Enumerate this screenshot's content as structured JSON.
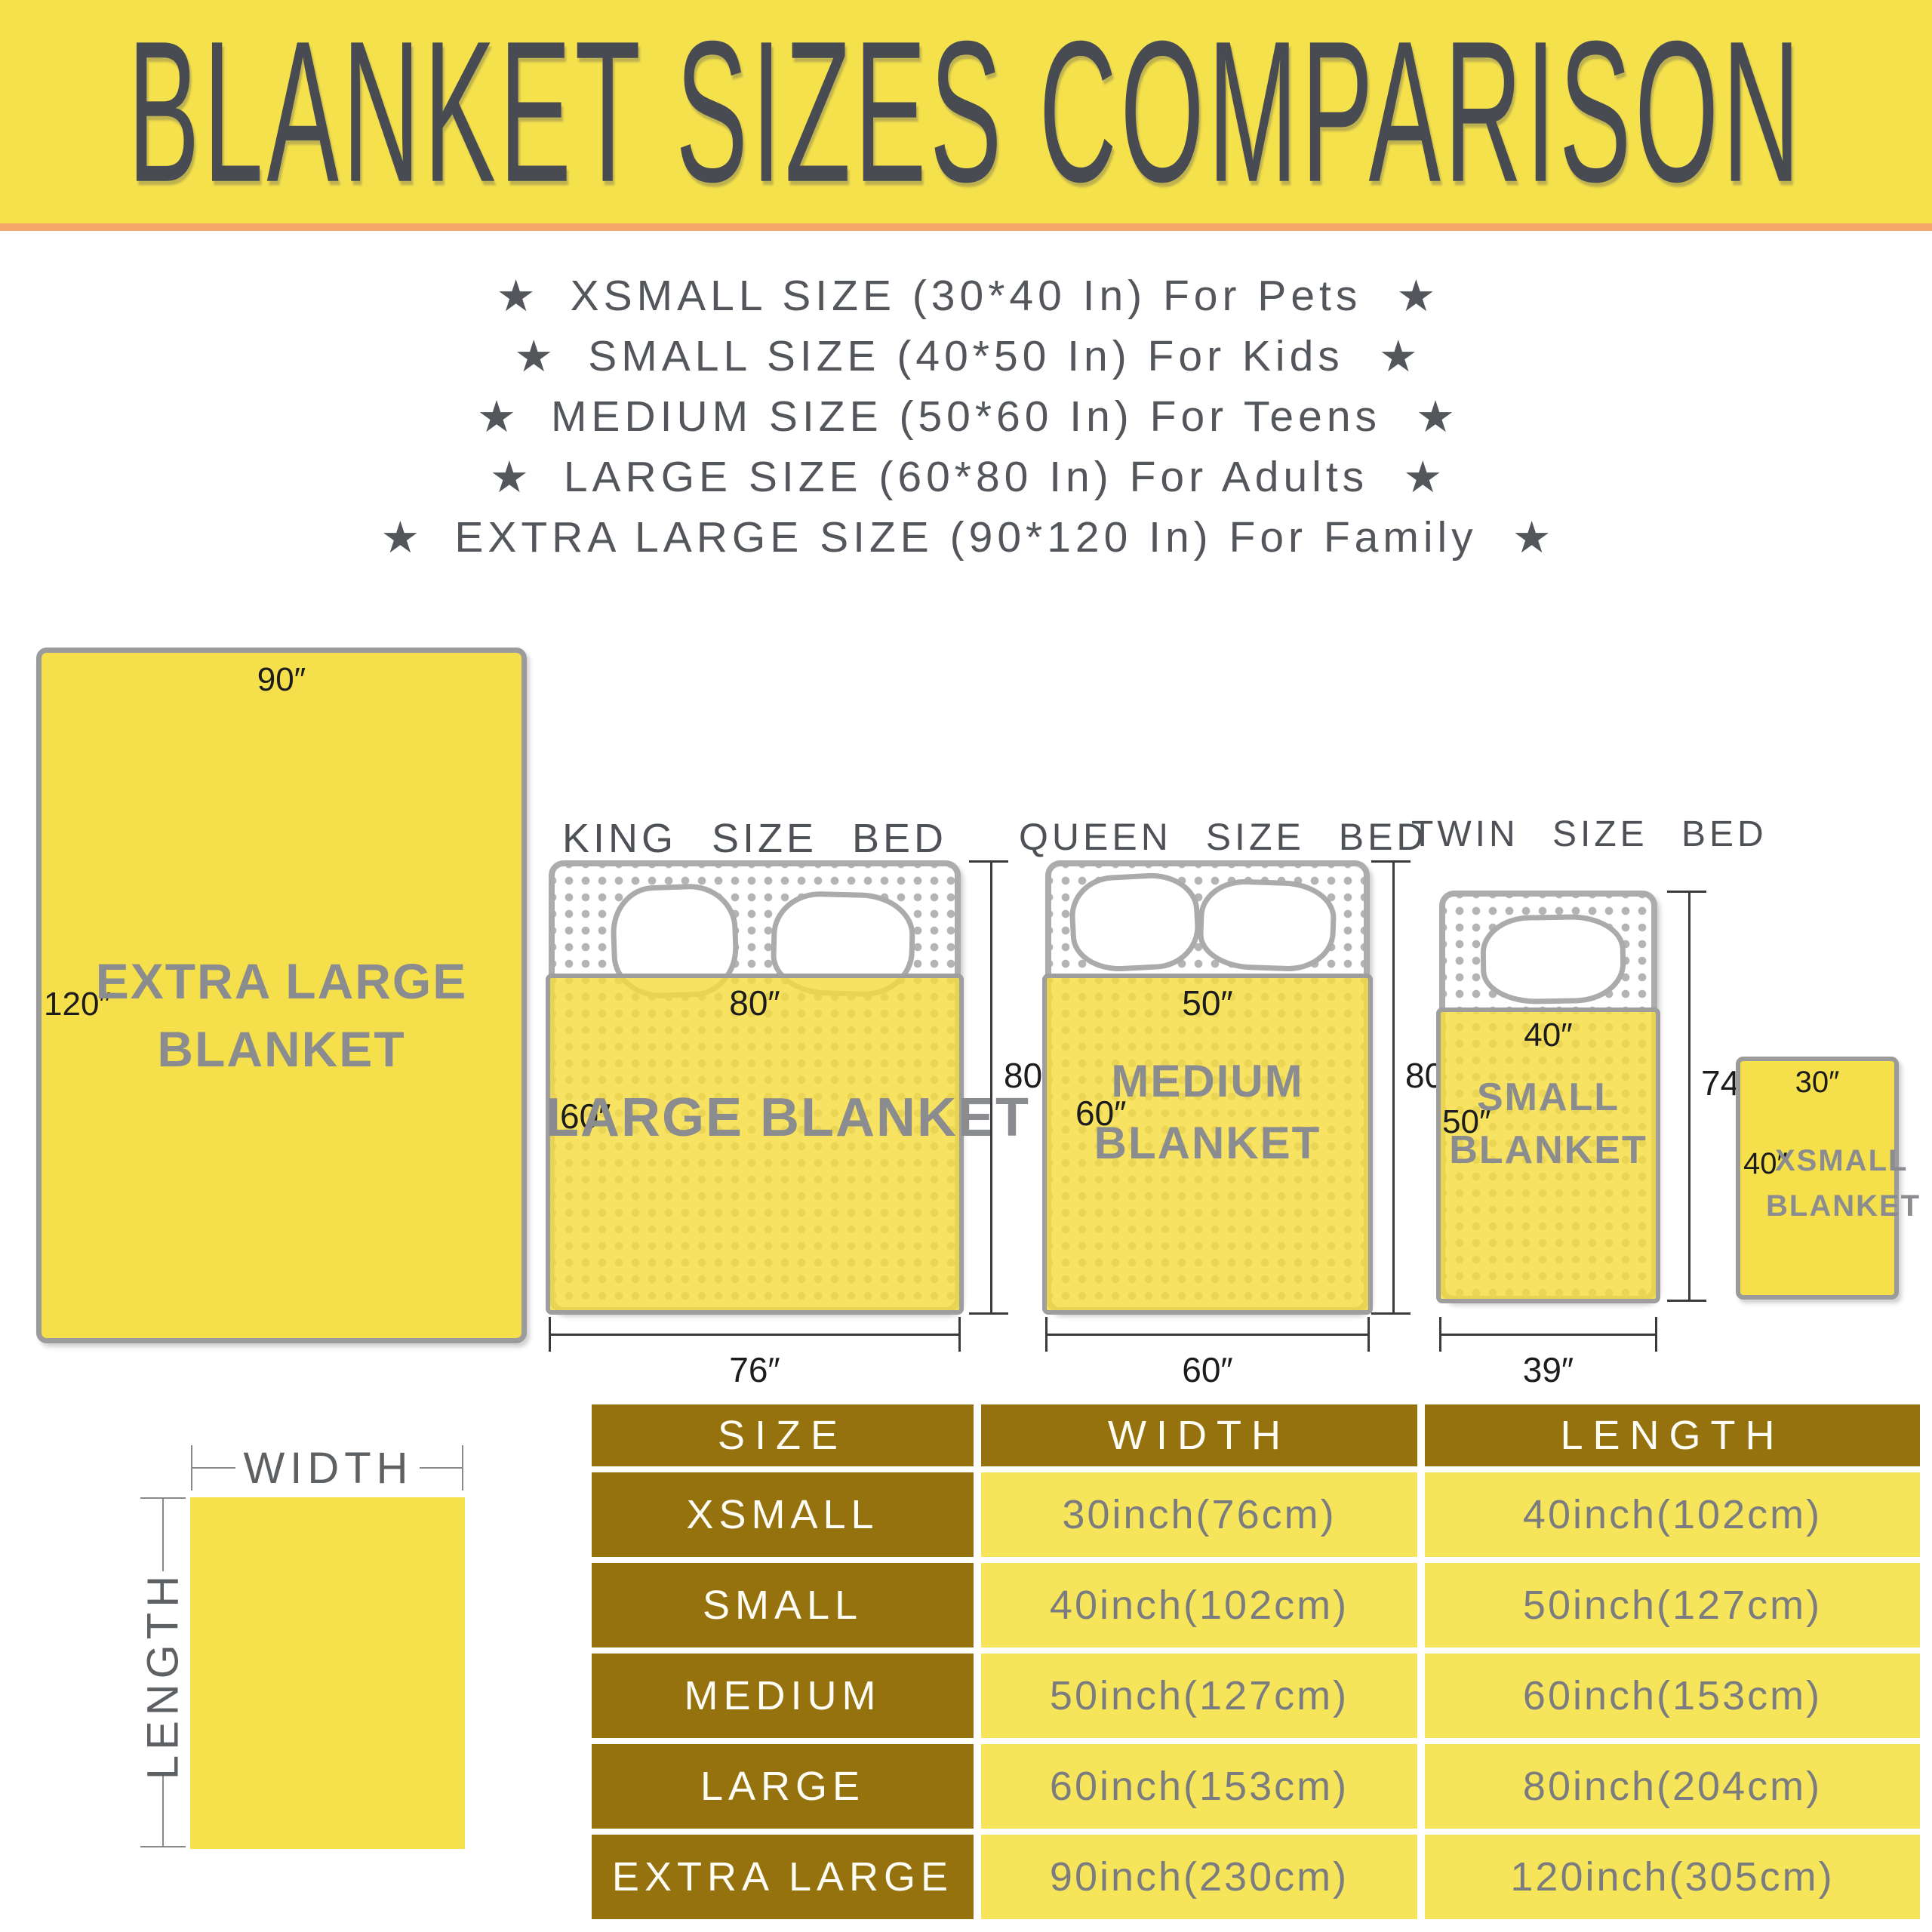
{
  "banner": {
    "title": "BLANKET SIZES COMPARISON",
    "bg": "#F5E14C",
    "accent_line_color": "#F3A76A"
  },
  "icons": {
    "star": "★"
  },
  "size_list": [
    {
      "text": "XSMALL SIZE (30*40 In) For Pets"
    },
    {
      "text": "SMALL SIZE (40*50 In) For Kids"
    },
    {
      "text": "MEDIUM SIZE (50*60 In) For Teens"
    },
    {
      "text": "LARGE SIZE (60*80 In) For Adults"
    },
    {
      "text": "EXTRA LARGE SIZE (90*120 In) For Family"
    }
  ],
  "diagram": {
    "xl": {
      "width_label": "90″",
      "length_label": "120″",
      "name_line1": "EXTRA LARGE",
      "name_line2": "BLANKET"
    },
    "king": {
      "title": "KING SIZE BED",
      "blanket_width": "80″",
      "blanket_length": "60″",
      "blanket_name": "LARGE BLANKET",
      "bed_width": "76″",
      "bed_length": "80″"
    },
    "queen": {
      "title": "QUEEN SIZE BED",
      "blanket_width": "50″",
      "blanket_length": "60″",
      "blanket_name_line1": "MEDIUM",
      "blanket_name_line2": "BLANKET",
      "bed_width": "60″",
      "bed_length": "80″"
    },
    "twin": {
      "title": "TWIN SIZE BED",
      "blanket_width": "40″",
      "blanket_length": "50″",
      "blanket_name_line1": "SMALL",
      "blanket_name_line2": "BLANKET",
      "bed_width": "39″",
      "bed_length": "74″"
    },
    "xsmall": {
      "width_label": "30″",
      "length_label": "40″",
      "name_line1": "XSMALL",
      "name_line2": "BLANKET"
    }
  },
  "legend": {
    "width_label": "WIDTH",
    "length_label": "LENGTH"
  },
  "table": {
    "headers": [
      "SIZE",
      "WIDTH",
      "LENGTH"
    ],
    "rows": [
      {
        "size": "XSMALL",
        "width": "30inch(76cm)",
        "length": "40inch(102cm)"
      },
      {
        "size": "SMALL",
        "width": "40inch(102cm)",
        "length": "50inch(127cm)"
      },
      {
        "size": "MEDIUM",
        "width": "50inch(127cm)",
        "length": "60inch(153cm)"
      },
      {
        "size": "LARGE",
        "width": "60inch(153cm)",
        "length": "80inch(204cm)"
      },
      {
        "size": "EXTRA LARGE",
        "width": "90inch(230cm)",
        "length": "120inch(305cm)"
      }
    ]
  },
  "colors": {
    "banner_yellow": "#F5E14C",
    "accent_orange": "#F3A76A",
    "blanket_yellow": "#F5E04C",
    "table_brown": "#96720E",
    "table_cell_yellow": "#F6E45A",
    "title_text": "#484C52",
    "list_text": "#53565A",
    "blanket_name_gray": "#8A8C8F",
    "value_text_gray": "#7A7C7F",
    "bed_border_gray": "#ACACAC",
    "dimension_text": "#1C1C1E"
  }
}
